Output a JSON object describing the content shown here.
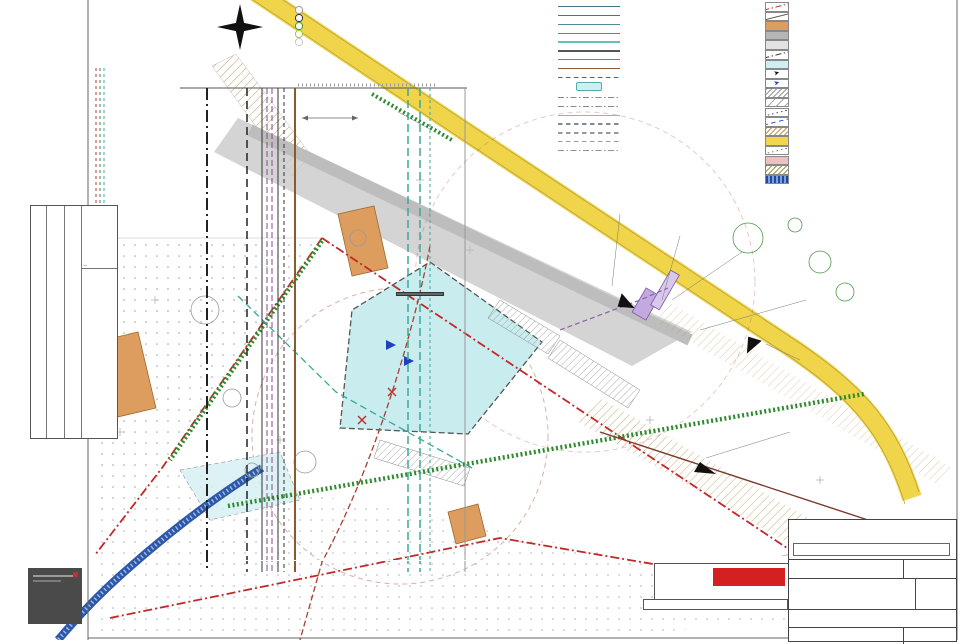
{
  "section": {
    "title": "Lõige A-A",
    "dim": "6.0",
    "pipes": [
      {
        "t": "olemasolev veetoru",
        "x": 203
      },
      {
        "t": "olemasolev kanalisatsioonitoru",
        "x": 243
      },
      {
        "t": "olemasolev sidekaabel",
        "x": 263
      },
      {
        "t": "G1 gaasitoru",
        "x": 291
      },
      {
        "t": "plan. veetoru V1",
        "x": 404
      },
      {
        "t": "plan. kanalisatsioonitoru K1",
        "x": 426
      },
      {
        "t": "krundi piir",
        "x": 461
      }
    ],
    "codes": [
      {
        "t": "W1",
        "x": 249,
        "y": 408,
        "c": "#555"
      },
      {
        "t": "G1",
        "x": 297,
        "y": 420,
        "c": "#8a5a2a"
      },
      {
        "t": "V1",
        "x": 410,
        "y": 400,
        "c": "#38a898"
      },
      {
        "t": "K1",
        "x": 422,
        "y": 432,
        "c": "#38a898"
      }
    ]
  },
  "compass": {
    "w": "W",
    "e": "E",
    "s": "S"
  },
  "legend_greenery": {
    "title": "Haljastuse väärtusklassid",
    "items": [
      {
        "label": "I  klassi  puud  ja  põõsad",
        "color": "#9a9a9a"
      },
      {
        "label": "II  klassi  puud  ja  põõsad",
        "color": "#333333"
      },
      {
        "label": "III  klassi  puud  ja  põõsad",
        "color": "#3a9a3a"
      },
      {
        "label": "IV  klassi  puud  ja  põõsad",
        "color": "#9ac73a"
      },
      {
        "label": "V  klassi  puud  ja  põõsad",
        "color": "#c8c8c8"
      }
    ]
  },
  "legend_utilities": {
    "planned": [
      {
        "code": "VD",
        "style": "solid",
        "color": "#447788",
        "label": "Vee ühendustoru"
      },
      {
        "code": "KD",
        "style": "solid",
        "color": "#447788",
        "label": "Kanalisatsiooni ühendustoru(isevoolne)"
      },
      {
        "code": "V1",
        "style": "solid",
        "color": "#558899",
        "label": "Kinnistusisene veetoru"
      },
      {
        "code": "K1",
        "style": "solid",
        "color": "#558899",
        "label": "Kinnistusisene kanalisatsioonitoru(isevoolne)"
      },
      {
        "code": "",
        "style": "solid",
        "color": "#66c2b8",
        "label": "Sademeveetoru"
      },
      {
        "code": "W1",
        "style": "solid",
        "color": "#555555",
        "label": "Madalpingekaabel"
      },
      {
        "code": "",
        "style": "solid",
        "color": "#aa6666",
        "label": "Sidekanalisatsioon"
      },
      {
        "code": "G1",
        "style": "solid",
        "color": "#8a5a2a",
        "label": "Kinnistusisene B-kat gaasitoru"
      },
      {
        "code": "",
        "style": "dash",
        "color": "#8a5a2a",
        "label": "Gaasitoru ühendus Kõrtsi tee 9 kinnistu lähistelt"
      },
      {
        "code": "box",
        "style": "box",
        "color": "#cdeef2",
        "label": "Liiva- ja õlipüüdur"
      }
    ],
    "existing_title": "Olemasolevad tehnovõrgud",
    "existing": [
      {
        "code": "",
        "style": "dashdot",
        "color": "#888888",
        "label": "Olemasolev veetoru"
      },
      {
        "code": "",
        "style": "dashdot",
        "color": "#888888",
        "label": "Olemasolev kanalisatsioonitoru"
      },
      {
        "code": "",
        "style": "solid",
        "color": "#aaaaaa",
        "label": "Olemasolev madalpingeõhuliin"
      },
      {
        "code": "",
        "style": "dash",
        "color": "#888888",
        "label": "Olemasolev kõrgpingeõhuliin"
      },
      {
        "code": "",
        "style": "dash",
        "color": "#999999",
        "label": "Olemasolev keskpingekaabel"
      },
      {
        "code": "",
        "style": "dash",
        "color": "#999999",
        "label": "Olemasolev sidekaabel"
      },
      {
        "code": "",
        "style": "dashdot",
        "color": "#aa8888",
        "label": "Olemasolev sidekanalisatsioon"
      }
    ]
  },
  "legend_symbols": {
    "items": [
      {
        "label": "Planeeritud ala piir",
        "kind": "dashdot",
        "color": "#cc2222"
      },
      {
        "label": "Kinnistu piir",
        "kind": "line",
        "color": "#555555"
      },
      {
        "label": "Olemasolev hoone",
        "kind": "fill",
        "color": "#dd9d5f"
      },
      {
        "label": "Olemasolev sõidutee",
        "kind": "fill",
        "color": "#b5b5b5"
      },
      {
        "label": "Planeeritud sõidutee",
        "kind": "fill",
        "color": "#e2e2e2"
      },
      {
        "label": "Hoonestusala piir",
        "kind": "dashdot",
        "color": "#333333"
      },
      {
        "label": "Hoone võimalik asukoht",
        "kind": "fill",
        "color": "#cdeef2"
      },
      {
        "label": "Pääs krundile",
        "kind": "arrow",
        "color": "#111111"
      },
      {
        "label": "Pääs hoonesse",
        "kind": "arrow",
        "color": "#2040c0"
      },
      {
        "label": "Planeeritud nähtavuskolmnurk 15x160m",
        "kind": "hatch",
        "color": "#999999"
      },
      {
        "label": "Tehnovõrgu servituudi vajadusega ala",
        "kind": "hatch2",
        "color": "#aaaaaa"
      },
      {
        "label": "Tee kaitsevööndi piir",
        "kind": "dots",
        "color": "#555555"
      },
      {
        "label": "Maantee sanitaarkaitse vööndi piir",
        "kind": "dash",
        "color": "#2255cc"
      },
      {
        "label": "Riigimaantee teemaale kavandatud tehnovõrgu kaitsevöönd",
        "kind": "hatch",
        "color": "#b89a5a"
      },
      {
        "label": "Perspektiivne avaliku kasutusega kõnnitee",
        "kind": "fill",
        "color": "#f2d64b"
      },
      {
        "label": "Planeeritud piirdeaia asukoht",
        "kind": "dots",
        "color": "#777777"
      },
      {
        "label": "Kergliiklustee avalik kasutus",
        "kind": "fill",
        "color": "#eac2c2"
      },
      {
        "label": "Võimalik jalgteede ühenduskoht",
        "kind": "hatch",
        "color": "#9a9a4a"
      },
      {
        "label": "Planeeritud kraav",
        "kind": "stripes",
        "color": "#1d49a0"
      },
      {
        "label": "Likvideeritav puu",
        "kind": "glyph",
        "color": "#222222",
        "glyph": "✳"
      },
      {
        "label": "Naaberkinnistul soovituslikult likvideeritav puu",
        "kind": "glyph",
        "color": "#2d8a2d",
        "glyph": "✳"
      },
      {
        "label": "Istutatav hekk",
        "kind": "hedge",
        "color": "#2d8a2d"
      }
    ]
  },
  "plan": {
    "labels": [
      {
        "t": "Olemasolev\ntuletõrjehüdrant",
        "x": 340,
        "y": 103,
        "s": 5.5,
        "c": "#333",
        "w": 60,
        "a": "right"
      },
      {
        "t": "65301:002:0432",
        "x": 398,
        "y": 68,
        "r": 26,
        "s": 5.5,
        "c": "#999"
      },
      {
        "t": "65301:002:0967  Põrguvälja tee L7",
        "x": 438,
        "y": 82,
        "r": 26,
        "s": 5.5,
        "c": "#999"
      },
      {
        "t": "Põrguvälja tee",
        "x": 466,
        "y": 184,
        "r": 27,
        "s": 6,
        "c": "#888"
      },
      {
        "t": "65301:002:0898",
        "x": 682,
        "y": 229,
        "s": 6,
        "c": "#999"
      },
      {
        "t": "Lille",
        "x": 724,
        "y": 251,
        "s": 5.5,
        "c": "#888"
      },
      {
        "t": "Männi",
        "x": 280,
        "y": 287,
        "s": 5.5,
        "c": "#777"
      },
      {
        "t": "65301:002:0097",
        "x": 268,
        "y": 296,
        "s": 5,
        "c": "#999"
      },
      {
        "t": "65301:002:0419",
        "x": 632,
        "y": 439,
        "s": 5.5,
        "c": "#999",
        "bg": true
      },
      {
        "t": "Põrguvälja tee 25",
        "x": 632,
        "y": 448,
        "s": 5.5,
        "c": "#999",
        "bg": true
      },
      {
        "t": "Järveküla–Jüri tee\n65301:002:0286",
        "x": 733,
        "y": 377,
        "r": 33,
        "s": 5,
        "c": "#999"
      },
      {
        "t": "1330-Järveküla-Jüri tee\nkaitsevöönd sõidutee teljest 50m",
        "x": 538,
        "y": 426,
        "r": 52,
        "s": 5,
        "c": "#888"
      },
      {
        "t": "Kaj javere",
        "x": 406,
        "y": 483,
        "s": 5.5,
        "c": "#888",
        "bg": true
      },
      {
        "t": "tuletõrjehüdrant\nlähistelt",
        "x": 196,
        "y": 369,
        "s": 5,
        "c": "#b05038"
      },
      {
        "t": "tuletõrjehüdrant\nlähistelt 100m",
        "x": 418,
        "y": 519,
        "s": 5,
        "c": "#2a8a8a",
        "bg": true
      },
      {
        "t": "GAS",
        "x": 636,
        "y": 427,
        "r": 23,
        "s": 6,
        "c": "#666"
      },
      {
        "t": "A",
        "x": 320,
        "y": 284,
        "r": -25,
        "s": 14,
        "c": "#111",
        "b": true
      },
      {
        "t": "A",
        "x": 500,
        "y": 408,
        "r": -25,
        "s": 14,
        "c": "#111",
        "b": true
      },
      {
        "t": "Olemasolev\ntuletõrjehüdrant",
        "x": 746,
        "y": 360,
        "s": 5.5,
        "c": "#333",
        "bg": true
      },
      {
        "t": "Riigimaantee nr 1330 Järveküla-Jüri tee",
        "x": 650,
        "y": 438,
        "r": 32,
        "s": 4.5,
        "c": "#999"
      },
      {
        "t": "65301:002:0398 Järveküla-Jüri tee",
        "x": 688,
        "y": 480,
        "r": 32,
        "s": 4.5,
        "c": "#999"
      },
      {
        "t": "6.0",
        "x": 318,
        "y": 107,
        "s": 5.5,
        "c": "#666"
      },
      {
        "t": "1",
        "x": 396,
        "y": 281,
        "s": 6,
        "c": "#333",
        "circle": true
      },
      {
        "t": "19",
        "x": 291,
        "y": 425,
        "s": 4.6,
        "c": "#777",
        "circle": true
      }
    ],
    "callouts": [
      {
        "x": 571,
        "y": 203,
        "w": 150,
        "box": false,
        "t": "AS Elveso teh. tingimustele nr 4-11/967-1\nÜhisveevõrguga liitumise punkt."
      },
      {
        "x": 695,
        "y": 213,
        "w": 112,
        "box": true,
        "t": "Vastavalt AS Elveso teh. tingimustele nr 4-11/967-1 ette nähtud loomine isevoolse kanalisatsiooni torustikuga."
      },
      {
        "x": 762,
        "y": 243,
        "w": 118,
        "box": true,
        "t": "Vastavalt AS Elveso teh. tingimustele nr 4-11/967-1 ühenduse loomine ühisveevõrguga."
      },
      {
        "x": 766,
        "y": 288,
        "w": 125,
        "box": true,
        "t": "Vastavalt Elion Ettevõtted AS tingimustele nr 19302912 on ette nähtud sidekanalisatsioonitrassiga liitumine kaevust AS-113."
      },
      {
        "x": 789,
        "y": 347,
        "w": 105,
        "box": true,
        "t": "Vastavalt Elektrilevi OÜ teh. tingimustele nr 200500 Ühenduse loomine \"Lille\" alajaamast."
      },
      {
        "x": 762,
        "y": 420,
        "w": 115,
        "box": true,
        "t": "Vastavalt Elektrilevi OÜ teh. tingimustele nr 200500 ette nähtud liitumiskilp /liitumispunkt."
      }
    ],
    "building": {
      "r1": "TJ60/40",
      "r2": "±0.00=55.50",
      "r3": "4 501 m²",
      "p1": "P",
      "p2": "P"
    }
  },
  "notes": {
    "title": "Märkused:",
    "items": [
      "Dendroloogilise plaani koostas Olev Abner 16. märts 2011. a.",
      "Pöörderaadiuste määramisel kasutatud arvutusliku sadulauto pikkus on 15,39 m ja laius 2,55 m.",
      "Detailplaneeringus on planeeritud krundi tehnovõrkude lahendused põhimõttelised. Tehnovõrkude lahenduse autoriks on Nipnup OÜ, 09.02.2013 töö.",
      "Gaasitrassi projekteerimisel muuta liitumispunkti asukohta trassi kulgemise suunal."
    ]
  },
  "indicators": {
    "title": "Näitajad planeeritava ala kohta:",
    "rows": [
      {
        "label": "Planeeritud maa-ala suurus:",
        "value": "0,7 ha",
        "bullet": true
      },
      {
        "label": "Kavandatud kruntide arv:",
        "value": "1",
        "bullet": true
      },
      {
        "label": "Krunditud maa bilanss:",
        "value": "",
        "bullet": true
      },
      {
        "label": "tootmismaa  –",
        "value": "3931 m²",
        "sub": true
      },
      {
        "label": "ärimaa  –",
        "value": "2620 m²",
        "sub": true
      },
      {
        "label": "Maapealne suletud brutopind:",
        "value": "3200 m²",
        "bullet": true
      },
      {
        "label": "Kavandatud hoonestustihedus:",
        "value": "0,49",
        "bullet": true
      },
      {
        "label": "Norm./plan. parkimiskohtade arv:",
        "value": "16/17",
        "bullet": true
      }
    ]
  },
  "approvals": {
    "headers": [
      "Kooskõlastused",
      "kuupäev",
      "number"
    ],
    "rows": [
      [
        "Elion Ettevõtted AS",
        "19.10.2012.a.",
        "NR 20205546"
      ],
      [
        "OÜ Jaotusvõre",
        "08.12.2010.a",
        "nr. 9411"
      ],
      [
        "AS Elveso",
        "02.03.2011.a",
        "VK_KK nr. 016"
      ]
    ]
  },
  "titleblock": {
    "remarks_label": "Märkused",
    "remark": "Väljastatud teostusjoonis TJ 15464, TJ18470",
    "code": "DP-57-13",
    "sheet_label": "Leht nr",
    "sheet": "DP-5",
    "project": "KADAKA KINNISTU JA LÄHIALA DETAILPLANEERING",
    "stage_label": "Staadium",
    "stage": "DP",
    "address_label": "Aadress",
    "address": "HARJUMAA, RAE VALD, LEHMJA KÜLA, KADAKA",
    "drawing_label": "Joonis",
    "drawing": "TEHNOVÕRKUDE KOONDPLAAN",
    "scale_label": "Mõõtkava",
    "scale": "1:500"
  },
  "firm": {
    "line1": "Guru Projekt OÜ",
    "line2": "Tatari tn 26-1",
    "line3": "Tallinn 10116",
    "line4": "tel 660 4815",
    "line5": "info@guruprojekt.ee",
    "logo": "guru",
    "logo_sub": "PROJEKT"
  },
  "personnel": {
    "client_label": "Tellija:",
    "client": "Viseing Family, reg nr 12840512, Väike 20-5, Tallinn 10134, rene@viseing.ee",
    "rows": [
      [
        "Arh.",
        "J. Rebane",
        "",
        "13.04.2013"
      ],
      [
        "Teht.",
        "R. Pilm",
        "",
        ""
      ],
      [
        "Teht.",
        "A. Pajusova",
        "",
        ""
      ]
    ]
  },
  "survey": {
    "notes": "Märkused: Koordinaadid L-Est 97 süsteemis. Kõrgused Balti süsteemis.",
    "address": "Aadress: Harjumaa, Rae vald, Lehmja küla, Kadaka",
    "firm": "OÜ Amoote AKM",
    "type": "Mõõdistuse liik: MAA-ALA PLAAN TEHNOVÕRKUDEGA",
    "logo1": "GEO",
    "logo2": "MAP",
    "job_label": "Töö nr.",
    "job": "T-100-12",
    "file": "MOOB F-508",
    "date": "20.10.2012",
    "sheet": "Leht 1",
    "sheets": "Lehti 1"
  },
  "badge": {
    "number": "24"
  }
}
